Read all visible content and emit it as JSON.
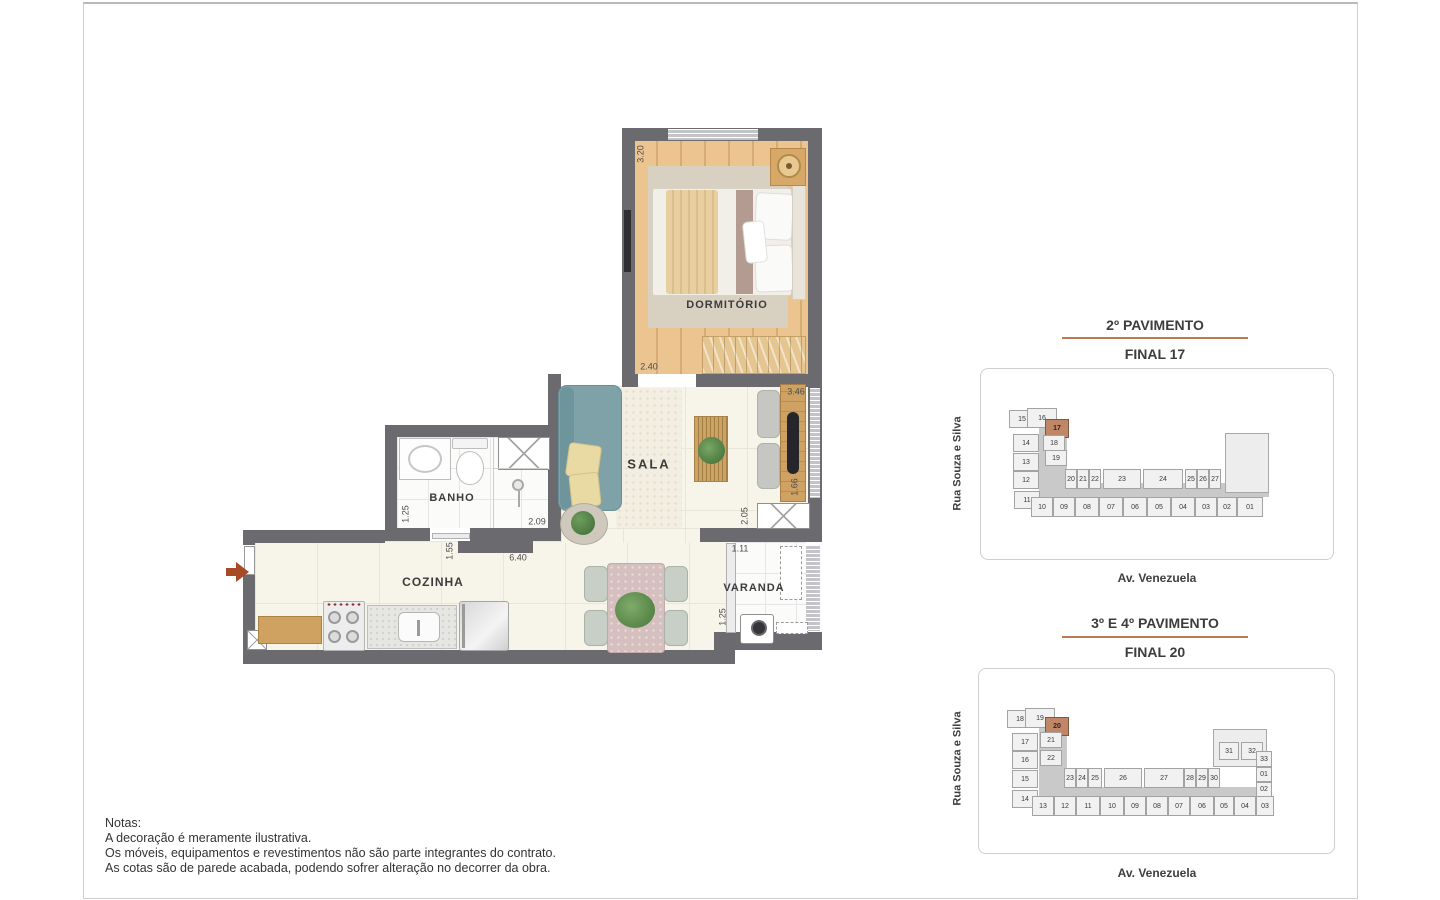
{
  "plan": {
    "rooms": {
      "dormitorio": "DORMITÓRIO",
      "sala": "SALA",
      "banho": "BANHO",
      "cozinha": "COZINHA",
      "varanda": "VARANDA"
    },
    "dimensions": {
      "dorm_left": "3.20",
      "dorm_bottom": "2.40",
      "sala_right_top": "3.46",
      "tv_wall": "1.66",
      "sala_right_bottom": "2.05",
      "banho_left": "1.25",
      "banho_bottom": "2.09",
      "hall": "1.55",
      "cozinha_width": "6.40",
      "varanda_top": "1.11",
      "varanda_left": "1.25"
    }
  },
  "key_plans": [
    {
      "title": "2º PAVIMENTO",
      "final_label": "FINAL 17",
      "street_side": "Rua Souza e Silva",
      "street_bottom": "Av. Venezuela",
      "highlight_unit": "17",
      "units": [
        {
          "n": "15",
          "x": 28,
          "y": 41,
          "w": 26,
          "h": 18
        },
        {
          "n": "16",
          "x": 46,
          "y": 39,
          "w": 30,
          "h": 20
        },
        {
          "n": "17",
          "x": 64,
          "y": 50,
          "w": 24,
          "h": 19,
          "hl": true
        },
        {
          "n": "14",
          "x": 32,
          "y": 65,
          "w": 26,
          "h": 18
        },
        {
          "n": "18",
          "x": 62,
          "y": 66,
          "w": 22,
          "h": 16
        },
        {
          "n": "13",
          "x": 32,
          "y": 84,
          "w": 26,
          "h": 18
        },
        {
          "n": "19",
          "x": 64,
          "y": 81,
          "w": 22,
          "h": 16
        },
        {
          "n": "12",
          "x": 32,
          "y": 102,
          "w": 26,
          "h": 18
        },
        {
          "n": "11",
          "x": 33,
          "y": 122,
          "w": 26,
          "h": 18
        },
        {
          "n": "20",
          "x": 84,
          "y": 100,
          "w": 12,
          "h": 20
        },
        {
          "n": "21",
          "x": 96,
          "y": 100,
          "w": 12,
          "h": 20
        },
        {
          "n": "22",
          "x": 108,
          "y": 100,
          "w": 12,
          "h": 20
        },
        {
          "n": "23",
          "x": 122,
          "y": 100,
          "w": 38,
          "h": 20
        },
        {
          "n": "24",
          "x": 162,
          "y": 100,
          "w": 40,
          "h": 20
        },
        {
          "n": "25",
          "x": 204,
          "y": 100,
          "w": 12,
          "h": 20
        },
        {
          "n": "26",
          "x": 216,
          "y": 100,
          "w": 12,
          "h": 20
        },
        {
          "n": "27",
          "x": 228,
          "y": 100,
          "w": 12,
          "h": 20
        },
        {
          "n": "10",
          "x": 50,
          "y": 128,
          "w": 22,
          "h": 20
        },
        {
          "n": "09",
          "x": 72,
          "y": 128,
          "w": 22,
          "h": 20
        },
        {
          "n": "08",
          "x": 94,
          "y": 128,
          "w": 24,
          "h": 20
        },
        {
          "n": "07",
          "x": 118,
          "y": 128,
          "w": 24,
          "h": 20
        },
        {
          "n": "06",
          "x": 142,
          "y": 128,
          "w": 24,
          "h": 20
        },
        {
          "n": "05",
          "x": 166,
          "y": 128,
          "w": 24,
          "h": 20
        },
        {
          "n": "04",
          "x": 190,
          "y": 128,
          "w": 24,
          "h": 20
        },
        {
          "n": "03",
          "x": 214,
          "y": 128,
          "w": 22,
          "h": 20
        },
        {
          "n": "02",
          "x": 236,
          "y": 128,
          "w": 20,
          "h": 20
        },
        {
          "n": "01",
          "x": 256,
          "y": 128,
          "w": 26,
          "h": 20
        }
      ]
    },
    {
      "title": "3º E 4º PAVIMENTO",
      "final_label": "FINAL 20",
      "street_side": "Rua Souza e Silva",
      "street_bottom": "Av. Venezuela",
      "highlight_unit": "20",
      "units": [
        {
          "n": "18",
          "x": 28,
          "y": 41,
          "w": 26,
          "h": 18
        },
        {
          "n": "19",
          "x": 46,
          "y": 39,
          "w": 30,
          "h": 20
        },
        {
          "n": "20",
          "x": 66,
          "y": 48,
          "w": 24,
          "h": 19,
          "hl": true
        },
        {
          "n": "17",
          "x": 33,
          "y": 64,
          "w": 26,
          "h": 18
        },
        {
          "n": "21",
          "x": 61,
          "y": 63,
          "w": 22,
          "h": 16
        },
        {
          "n": "16",
          "x": 33,
          "y": 82,
          "w": 26,
          "h": 18
        },
        {
          "n": "22",
          "x": 61,
          "y": 81,
          "w": 22,
          "h": 16
        },
        {
          "n": "15",
          "x": 33,
          "y": 101,
          "w": 26,
          "h": 18
        },
        {
          "n": "14",
          "x": 33,
          "y": 121,
          "w": 26,
          "h": 18
        },
        {
          "n": "23",
          "x": 85,
          "y": 99,
          "w": 12,
          "h": 20
        },
        {
          "n": "24",
          "x": 97,
          "y": 99,
          "w": 12,
          "h": 20
        },
        {
          "n": "25",
          "x": 109,
          "y": 99,
          "w": 14,
          "h": 20
        },
        {
          "n": "26",
          "x": 125,
          "y": 99,
          "w": 38,
          "h": 20
        },
        {
          "n": "27",
          "x": 165,
          "y": 99,
          "w": 40,
          "h": 20
        },
        {
          "n": "28",
          "x": 205,
          "y": 99,
          "w": 12,
          "h": 20
        },
        {
          "n": "29",
          "x": 217,
          "y": 99,
          "w": 12,
          "h": 20
        },
        {
          "n": "30",
          "x": 229,
          "y": 99,
          "w": 12,
          "h": 20
        },
        {
          "n": "31",
          "x": 240,
          "y": 73,
          "w": 20,
          "h": 18
        },
        {
          "n": "32",
          "x": 262,
          "y": 73,
          "w": 22,
          "h": 18
        },
        {
          "n": "33",
          "x": 277,
          "y": 82,
          "w": 16,
          "h": 16
        },
        {
          "n": "01",
          "x": 277,
          "y": 98,
          "w": 16,
          "h": 15
        },
        {
          "n": "02",
          "x": 277,
          "y": 113,
          "w": 16,
          "h": 15
        },
        {
          "n": "13",
          "x": 53,
          "y": 127,
          "w": 22,
          "h": 20
        },
        {
          "n": "12",
          "x": 75,
          "y": 127,
          "w": 22,
          "h": 20
        },
        {
          "n": "11",
          "x": 97,
          "y": 127,
          "w": 24,
          "h": 20
        },
        {
          "n": "10",
          "x": 121,
          "y": 127,
          "w": 24,
          "h": 20
        },
        {
          "n": "09",
          "x": 145,
          "y": 127,
          "w": 22,
          "h": 20
        },
        {
          "n": "08",
          "x": 167,
          "y": 127,
          "w": 22,
          "h": 20
        },
        {
          "n": "07",
          "x": 189,
          "y": 127,
          "w": 22,
          "h": 20
        },
        {
          "n": "06",
          "x": 211,
          "y": 127,
          "w": 24,
          "h": 20
        },
        {
          "n": "05",
          "x": 235,
          "y": 127,
          "w": 20,
          "h": 20
        },
        {
          "n": "04",
          "x": 255,
          "y": 127,
          "w": 22,
          "h": 20
        },
        {
          "n": "03",
          "x": 277,
          "y": 127,
          "w": 18,
          "h": 20
        }
      ]
    }
  ],
  "notes": {
    "heading": "Notas:",
    "lines": [
      "A decoração é meramente ilustrativa.",
      "Os móveis, equipamentos e revestimentos não são parte integrantes do contrato.",
      "As cotas são de parede acabada, podendo sofrer alteração no decorrer da obra."
    ]
  },
  "colors": {
    "wall": "#6b6b6f",
    "accent_rule": "#bd7a50",
    "highlight_unit": "#bf8767",
    "wood": "#ebc48f",
    "sofa": "#7fa1a8"
  }
}
